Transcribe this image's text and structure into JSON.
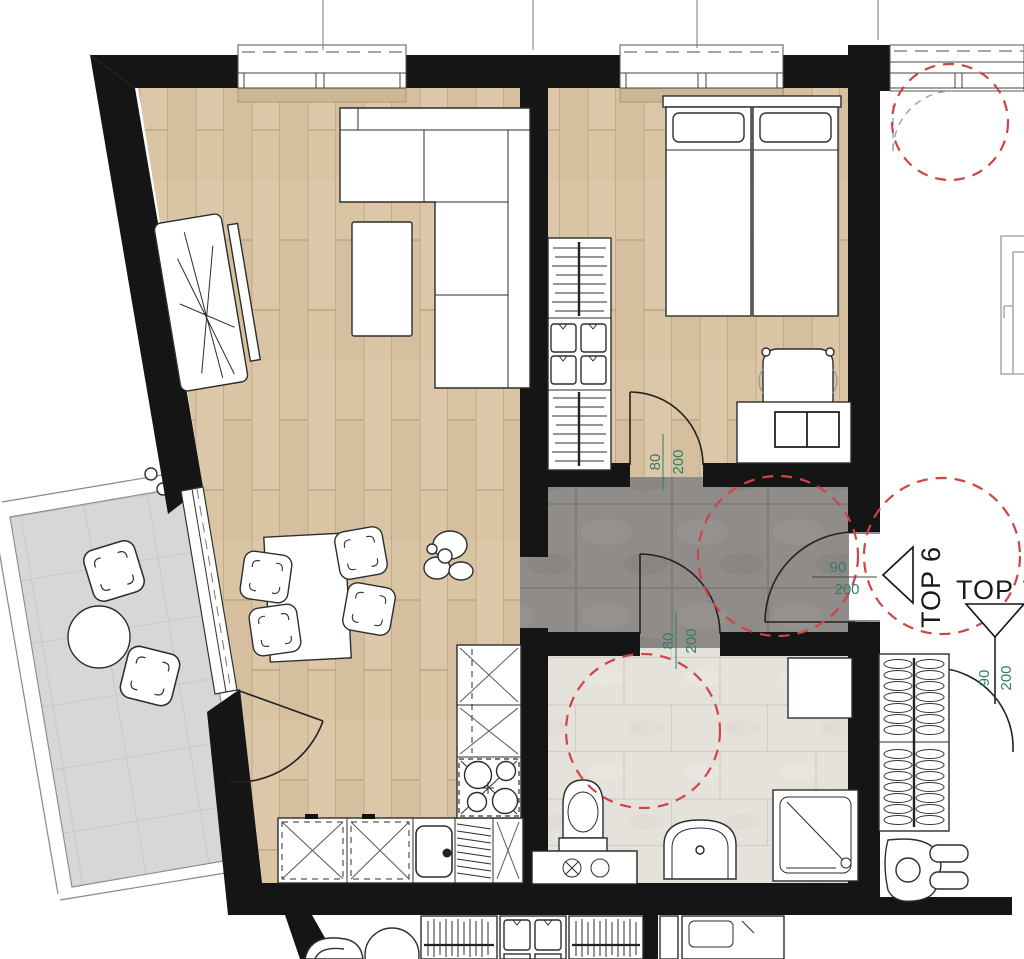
{
  "labels": {
    "top6": "TOP 6",
    "top7": "TOP 7"
  },
  "dims": {
    "bedroom": {
      "w": "80",
      "h": "200"
    },
    "bath": {
      "w": "80",
      "h": "200"
    },
    "entry": {
      "w": "90",
      "h": "200"
    },
    "top7": {
      "w": "90",
      "h": "200"
    }
  },
  "colors": {
    "wall": "#151515",
    "wood_floor": "#d9c4a4",
    "hall_tile": "#8f8c89",
    "bath_tile": "#e5e2db",
    "balcony_tile": "#d7d7d5",
    "dimension_green": "#2f7e69",
    "turning_circle_red": "#cf4444"
  }
}
